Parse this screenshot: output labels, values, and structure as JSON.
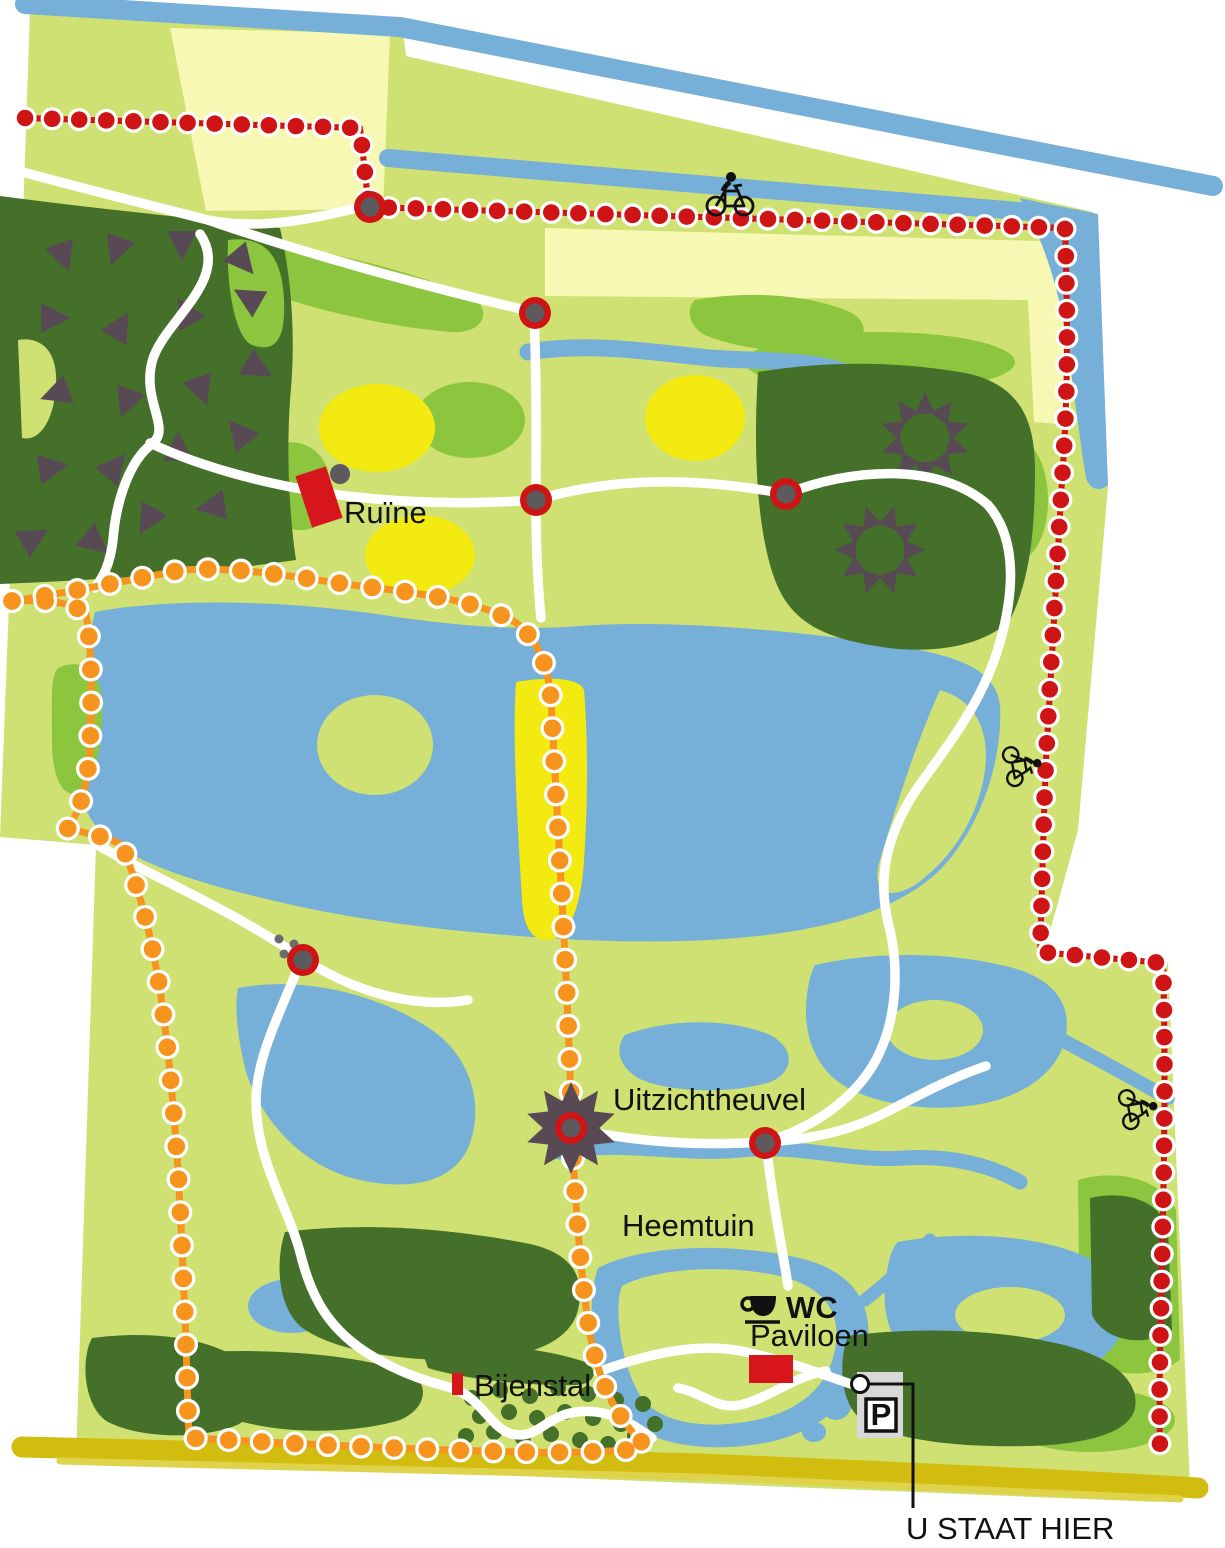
{
  "map": {
    "kind": "park-trail-map",
    "labels": {
      "ruin": "Ruïne",
      "viewpoint_hill": "Uitzichtheuvel",
      "heritage_garden": "Heemtuin",
      "toilets": "WC",
      "pavilion": "Paviloen",
      "apiary": "Bijenstal",
      "parking": "P",
      "you_are_here": "U STAAT HIER"
    },
    "icons": {
      "cyclist": "cyclist-icon",
      "coffee_cup": "coffee-cup-icon",
      "parking_sign": "parking-sign-icon",
      "viewpoint_star": "viewpoint-star-icon",
      "conifer_star": "conifer-star-icon",
      "route_node": "route-junction-node-icon",
      "ruin_building": "ruin-building-icon",
      "stepping_stones": "stepping-stones-icon"
    },
    "colors": {
      "meadow_green": "#cfe172",
      "shrub_green": "#8cc63f",
      "forest_green": "#44702a",
      "water_blue": "#76afd7",
      "field_pale_yellow": "#f6f8b4",
      "bright_yellow": "#f3ea12",
      "cycling_route_red": "#cf1416",
      "walking_route_orange": "#f7941e",
      "road_gold": "#d2bc10",
      "path_white": "#ffffff",
      "building_red": "#d6161c",
      "node_gray": "#5d5a5e",
      "star_gray": "#584a54",
      "ink_black": "#111111"
    }
  }
}
